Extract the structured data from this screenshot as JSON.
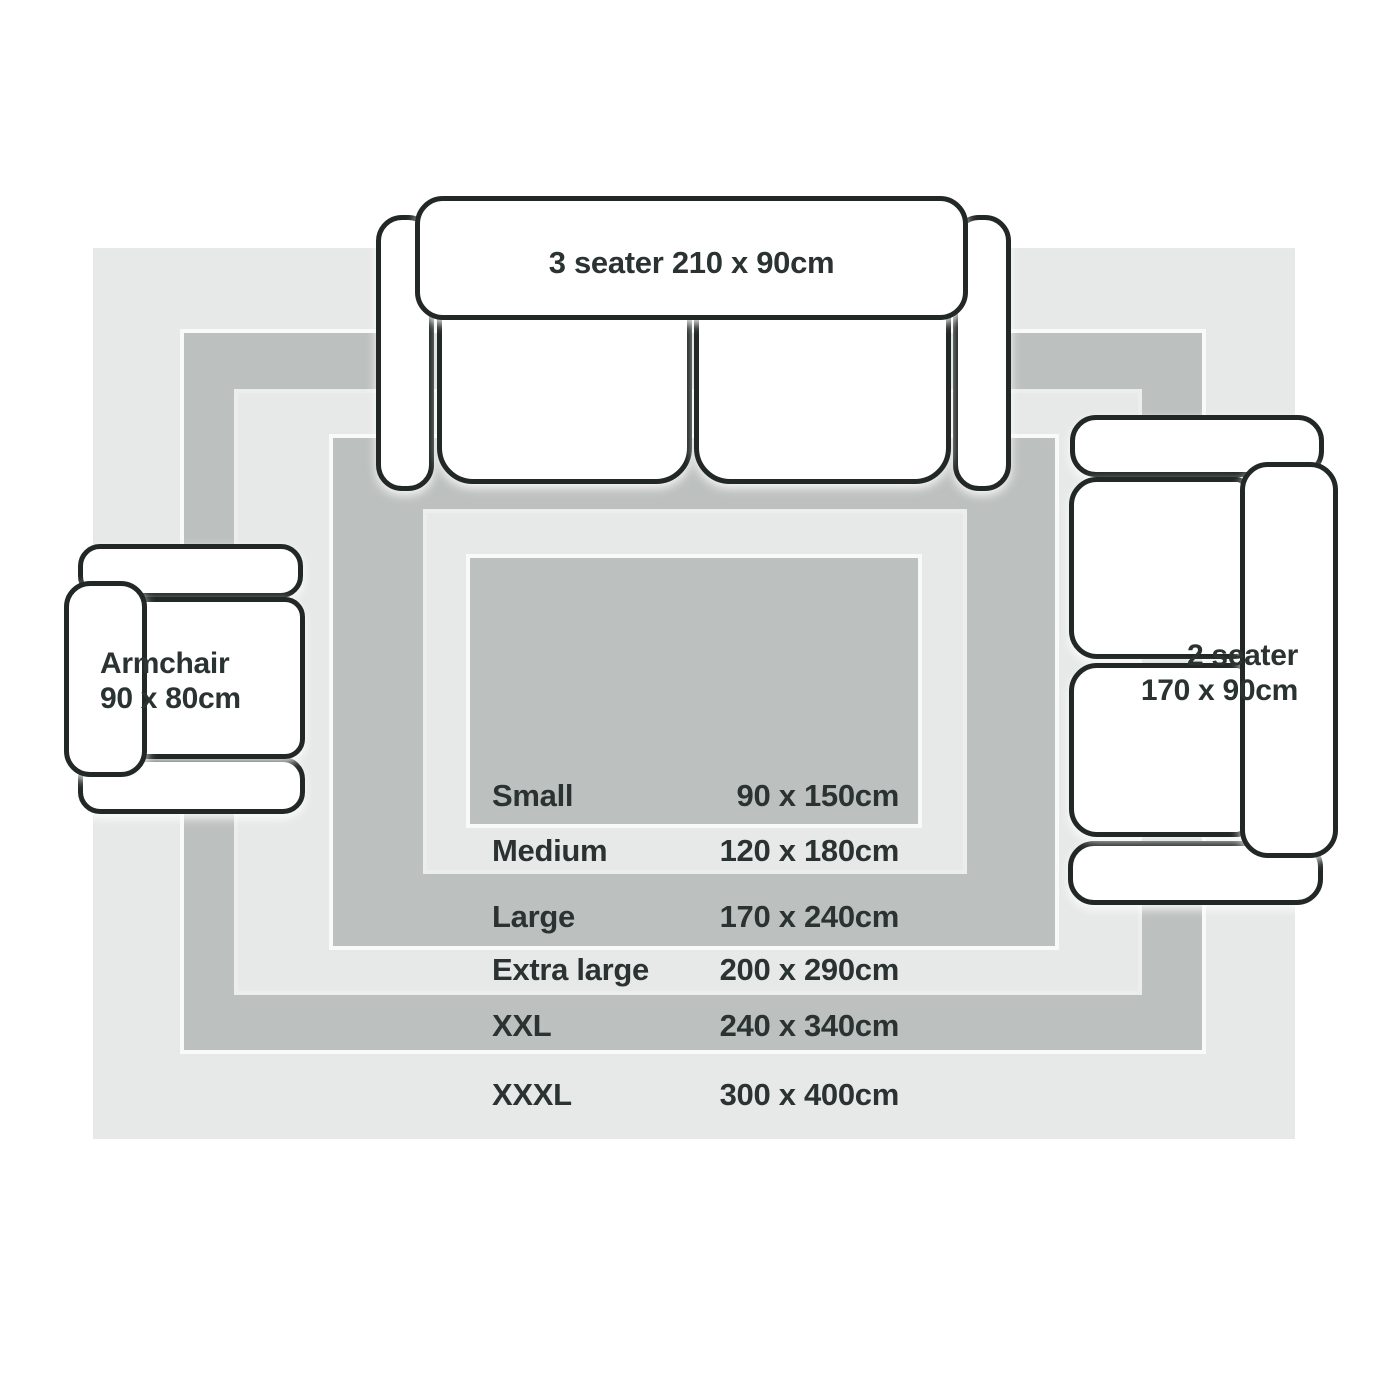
{
  "title": "Rug size guide",
  "furniture": {
    "three_seater": {
      "label": "3 seater 210 x 90cm"
    },
    "two_seater": {
      "name": "2 seater",
      "size": "170 x 90cm"
    },
    "armchair": {
      "name": "Armchair",
      "size": "90 x 80cm"
    }
  },
  "sizes": [
    {
      "name": "Small",
      "dimensions": "90 x 150cm"
    },
    {
      "name": "Medium",
      "dimensions": "120 x 180cm"
    },
    {
      "name": "Large",
      "dimensions": "170 x 240cm"
    },
    {
      "name": "Extra large",
      "dimensions": "200 x 290cm"
    },
    {
      "name": "XXL",
      "dimensions": "240 x 340cm"
    },
    {
      "name": "XXXL",
      "dimensions": "300 x 400cm"
    }
  ],
  "colors": {
    "page_background": "#ffffff",
    "rug_light": "#e7e9e8",
    "rug_dark": "#bcc0bf",
    "furniture_fill": "#ffffff",
    "furniture_outline": "#212825",
    "text": "#2b3332"
  }
}
